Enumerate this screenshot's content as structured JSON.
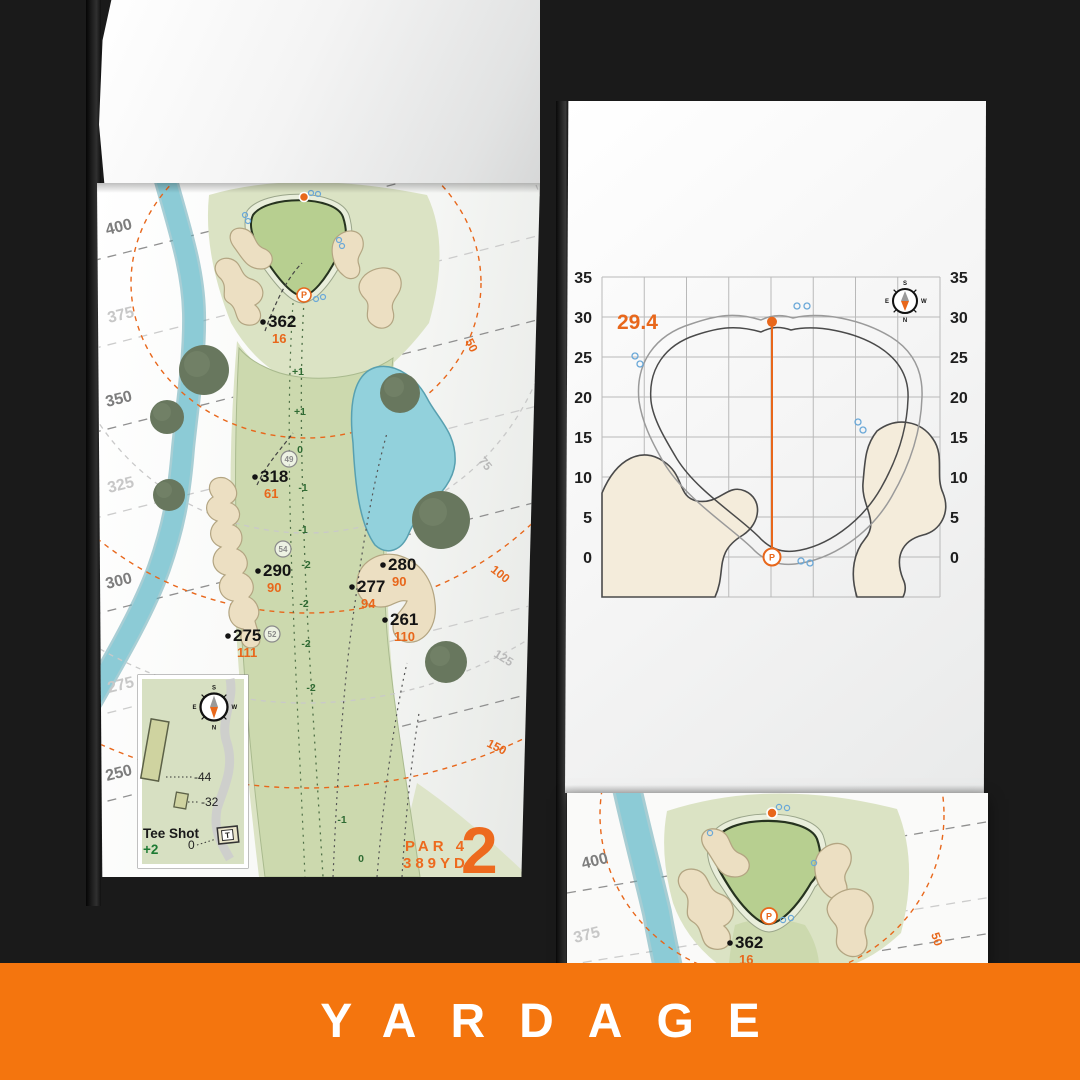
{
  "banner": {
    "label": "YARDAGE",
    "bg": "#F4750E"
  },
  "colors": {
    "accent": "#E8671B",
    "sand": "#ECDFC2",
    "water": "#8CCBD6",
    "green_fill": "#B7CF90",
    "fairway": "#CCD9AE",
    "surround": "#DBE3C4",
    "elevation_green": "#2F6B33"
  },
  "left_page": {
    "hole_number": "2",
    "par_label": "PAR 4",
    "yardage_label": "389YD",
    "compass": {
      "n": "N",
      "s": "S",
      "e": "E",
      "w": "W"
    },
    "distance_rings": [
      {
        "label": "400",
        "tone": "dark",
        "label_x": 10,
        "label_y": 52,
        "line_y": 78
      },
      {
        "label": "375",
        "tone": "light",
        "label_x": 12,
        "label_y": 140,
        "line_y": 166
      },
      {
        "label": "350",
        "tone": "dark",
        "label_x": 10,
        "label_y": 224,
        "line_y": 250
      },
      {
        "label": "325",
        "tone": "light",
        "label_x": 12,
        "label_y": 310,
        "line_y": 336
      },
      {
        "label": "300",
        "tone": "dark",
        "label_x": 10,
        "label_y": 406,
        "line_y": 432
      },
      {
        "label": "275",
        "tone": "light",
        "label_x": 12,
        "label_y": 510,
        "line_y": 534
      },
      {
        "label": "250",
        "tone": "dark",
        "label_x": 10,
        "label_y": 598,
        "line_y": 622
      }
    ],
    "pin_arcs": [
      {
        "label": "50",
        "tone": "orange",
        "rx": 175,
        "ry": 155,
        "lx": 368,
        "ly": 158,
        "rot": 64
      },
      {
        "label": "75",
        "tone": "gray",
        "rx": 250,
        "ry": 250,
        "lx": 381,
        "ly": 278,
        "rot": 50
      },
      {
        "label": "100",
        "tone": "orange",
        "rx": 330,
        "ry": 330,
        "lx": 393,
        "ly": 388,
        "rot": 38
      },
      {
        "label": "125",
        "tone": "gray",
        "rx": 420,
        "ry": 420,
        "lx": 396,
        "ly": 473,
        "rot": 32
      },
      {
        "label": "150",
        "tone": "orange",
        "rx": 505,
        "ry": 505,
        "lx": 389,
        "ly": 563,
        "rot": 27
      }
    ],
    "yardage_markers": [
      {
        "yards": "362",
        "pin": "16",
        "x": 166,
        "y": 144
      },
      {
        "yards": "318",
        "pin": "61",
        "x": 158,
        "y": 299
      },
      {
        "yards": "290",
        "pin": "90",
        "x": 161,
        "y": 393
      },
      {
        "yards": "280",
        "pin": "90",
        "x": 286,
        "y": 387
      },
      {
        "yards": "277",
        "pin": "94",
        "x": 255,
        "y": 409
      },
      {
        "yards": "261",
        "pin": "110",
        "x": 288,
        "y": 442
      },
      {
        "yards": "275",
        "pin": "111",
        "x": 131,
        "y": 458
      }
    ],
    "elevation_labels": [
      {
        "v": "+1",
        "x": 201,
        "y": 192
      },
      {
        "v": "+1",
        "x": 203,
        "y": 232
      },
      {
        "v": "0",
        "x": 203,
        "y": 270
      },
      {
        "v": "-1",
        "x": 206,
        "y": 308
      },
      {
        "v": "-1",
        "x": 206,
        "y": 350
      },
      {
        "v": "-2",
        "x": 209,
        "y": 385
      },
      {
        "v": "-2",
        "x": 207,
        "y": 424
      },
      {
        "v": "-2",
        "x": 209,
        "y": 464
      },
      {
        "v": "-2",
        "x": 214,
        "y": 508
      },
      {
        "v": "-1",
        "x": 245,
        "y": 640
      },
      {
        "v": "0",
        "x": 264,
        "y": 679
      }
    ],
    "circled_numbers": [
      {
        "v": "49",
        "x": 192,
        "y": 276
      },
      {
        "v": "54",
        "x": 186,
        "y": 366
      },
      {
        "v": "52",
        "x": 175,
        "y": 451
      }
    ],
    "tee_inset": {
      "title": "Tee Shot",
      "shot_score": "+2",
      "mark_back": "-44",
      "mark_mid": "-32",
      "mark_zero": "0",
      "tee_letter": "T"
    }
  },
  "right_page": {
    "chart": {
      "type": "diagram",
      "title_value": "29.4",
      "depth_value": 29.4,
      "y_ticks": [
        "35",
        "30",
        "25",
        "20",
        "15",
        "10",
        "5",
        "0"
      ],
      "y_step": 5,
      "ylim": [
        0,
        35
      ],
      "grid": true,
      "pin_letter": "P",
      "compass": {
        "n": "N",
        "s": "S",
        "e": "E",
        "w": "W"
      }
    }
  },
  "lower_page": {
    "distance_labels": [
      {
        "label": "400",
        "tone": "dark",
        "x": 16,
        "y": 76
      },
      {
        "label": "375",
        "tone": "light",
        "x": 8,
        "y": 150
      }
    ],
    "arc_label": {
      "label": "50",
      "x": 364,
      "y": 141,
      "rot": 72
    },
    "marker": {
      "yards": "362",
      "pin": "16",
      "x": 163,
      "y": 155
    },
    "pin_letter": "P"
  }
}
